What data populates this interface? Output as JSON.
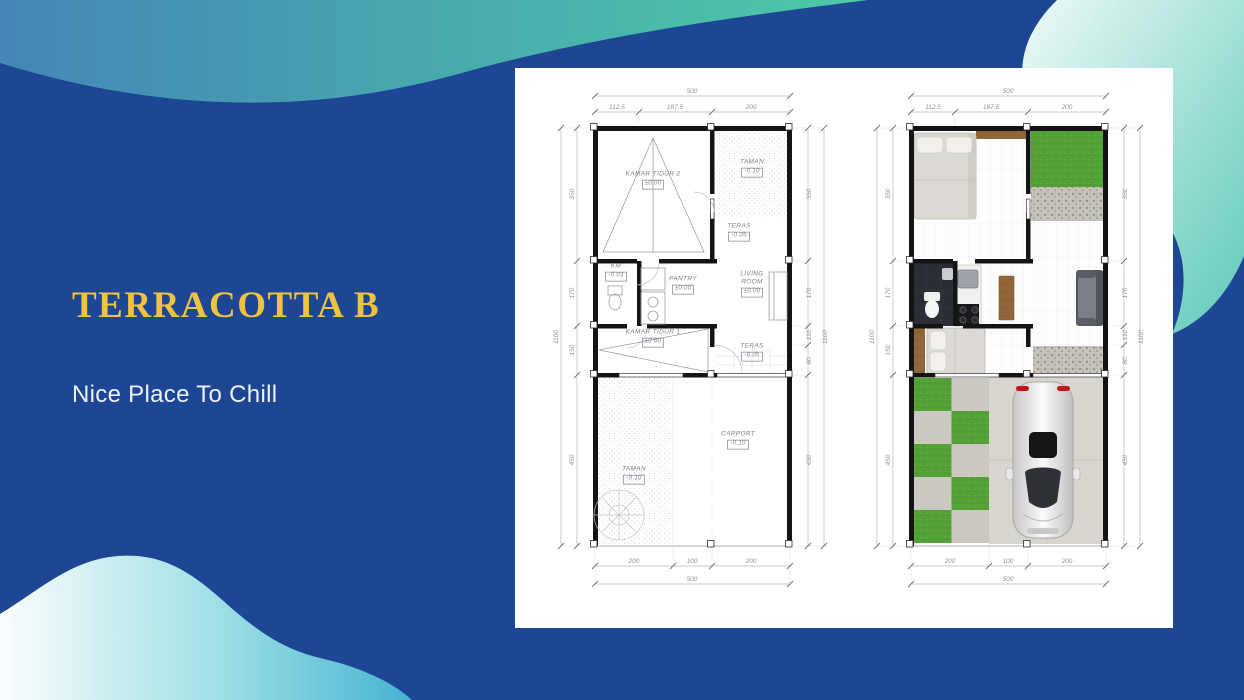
{
  "slide": {
    "title": "TERRACOTTA B",
    "subtitle": "Nice Place To Chill",
    "colors": {
      "background": "#1d4695",
      "accent_gold": "#eec33d",
      "teal": "#4ccaa6",
      "cyan": "#46b3d1",
      "mint": "#8ed9e2",
      "panel": "#ffffff",
      "wall": "#141414",
      "grass": "#55a338"
    }
  },
  "floorplan": {
    "dims": {
      "top_total": "500",
      "top_segments": [
        "112.5",
        "187.5",
        "200"
      ],
      "bottom_total": "500",
      "bottom_segments": [
        "200",
        "100",
        "200"
      ],
      "left_total": "1100",
      "left_segments": [
        "350",
        "170",
        "150",
        "450"
      ],
      "right_total": "1100",
      "right_segments": [
        "350",
        "170",
        "110",
        "80",
        "450"
      ]
    },
    "rooms": [
      {
        "name": "KAMAR TIDUR 2",
        "elev": "±0.00"
      },
      {
        "name": "TAMAN",
        "elev": "-0.10"
      },
      {
        "name": "TERAS",
        "elev": "-0.05"
      },
      {
        "name": "KM",
        "elev": "-0.03"
      },
      {
        "name": "PANTRY",
        "elev": "±0.00"
      },
      {
        "name": "LIVING ROOM",
        "elev": "±0.00"
      },
      {
        "name": "KAMAR TIDUR 1",
        "elev": "±0.00"
      },
      {
        "name": "TERAS",
        "elev": "-0.05"
      },
      {
        "name": "CARPORT",
        "elev": "-0.10"
      },
      {
        "name": "TAMAN",
        "elev": "-0.10"
      }
    ]
  }
}
